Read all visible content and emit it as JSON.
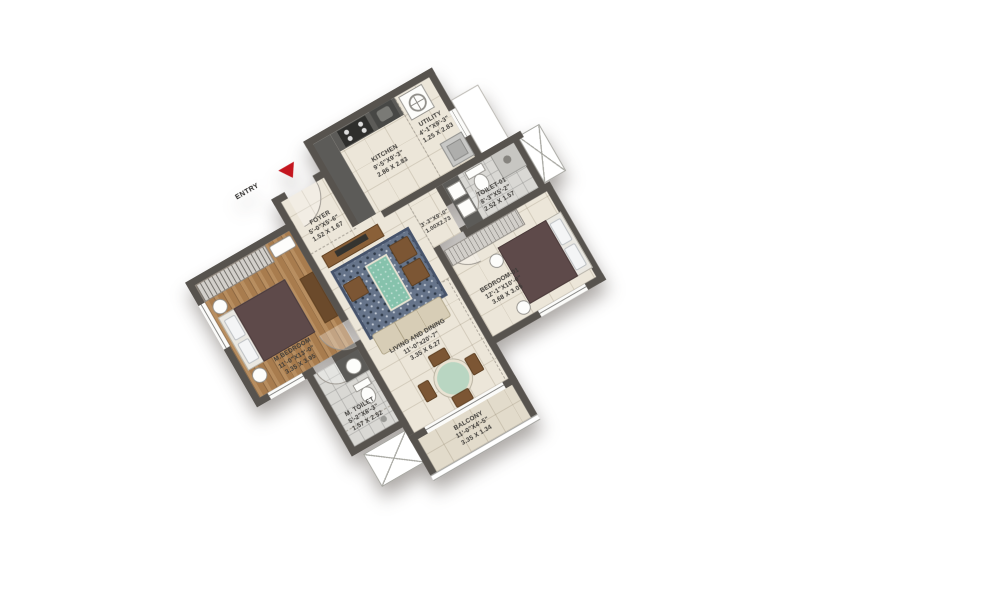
{
  "entry": {
    "label": "ENTRY"
  },
  "rooms": {
    "foyer": {
      "name": "FOYER",
      "dims_ft": "5'-0\"X5'-6\"",
      "dims_m": "1.52 X 1.67"
    },
    "kitchen": {
      "name": "KITCHEN",
      "dims_ft": "9'-5\"X9'-3\"",
      "dims_m": "2.86 X 2.83"
    },
    "utility": {
      "name": "UTILITY",
      "dims_ft": "4'-1\"X9'-3\"",
      "dims_m": "1.25 X 2.83"
    },
    "passage": {
      "dims_ft": "3'-3\"X9'-0\"",
      "dims_m": "1.00X2.73"
    },
    "toilet01": {
      "name": "TOILET-01",
      "dims_ft": "8'-3\"X5'-2\"",
      "dims_m": "2.52 X 1.57"
    },
    "living": {
      "name": "LIVING AND DINING",
      "dims_ft": "11'-0\"x20'-7\"",
      "dims_m": "3.35 X 6.27"
    },
    "mbedroom": {
      "name": "M.BEDROOM",
      "dims_ft": "11'-0\"X13'-0\"",
      "dims_m": "3.35 X 3.95"
    },
    "mtoilet": {
      "name": "M. TOILET",
      "dims_ft": "5'-2\"X8'-3\"",
      "dims_m": "1.57 X 2.52"
    },
    "bedroom01": {
      "name": "BEDROOM-01",
      "dims_ft": "12'-1\"X10'-0\"",
      "dims_m": "3.68 X 3.05"
    },
    "balcony": {
      "name": "BALCONY",
      "dims_ft": "11'-0\"X4'-5\"",
      "dims_m": "3.35 X 1.34"
    }
  },
  "colors": {
    "wall": "#57534e",
    "floor_tile": "#ece6d9",
    "toilet_tile": "#d9d8d4",
    "wood_floor": "#a87c4e",
    "balcony_tile": "#e2dbcb",
    "entry_arrow_red": "#c4161f",
    "rug": "#66748a",
    "coffee_table_teal": "#86c2ac",
    "bed_blanket": "#5e4a4a",
    "counter_dark": "#5c5b58",
    "sofa_beige": "#d7cdb6"
  }
}
